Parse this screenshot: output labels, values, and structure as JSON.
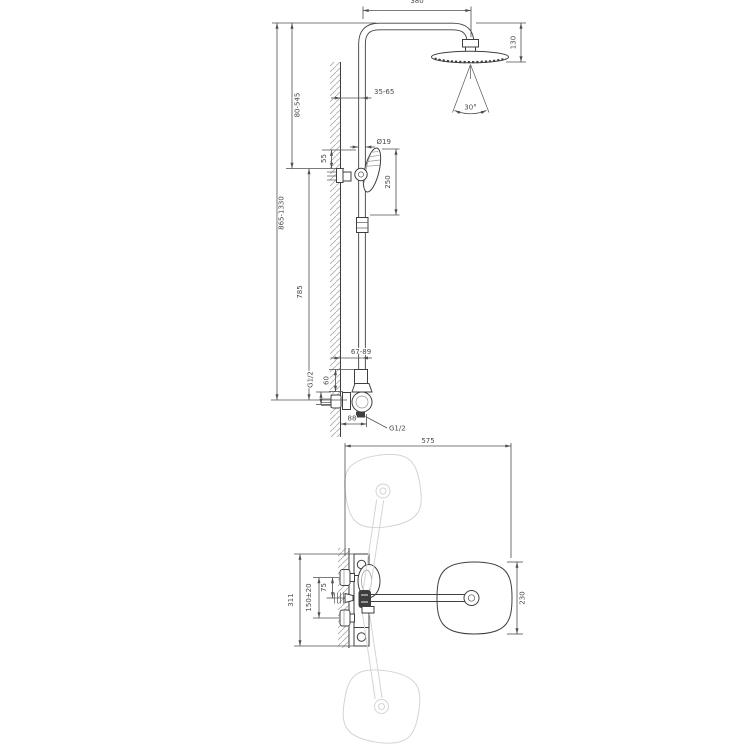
{
  "front": {
    "dims": {
      "arm_reach": "380",
      "head_drop": "130",
      "spray_angle": "30°",
      "wall_clearance_top": "35-65",
      "rail_diameter": "Ø19",
      "hand_shower_span": "250",
      "holder_offset": "55",
      "upper_adjust_range": "80-545",
      "overall_height_range": "865-1330",
      "rail_length": "785",
      "wall_clearance_bottom": "67-89",
      "valve_body_height": "60",
      "inlet_thread": "G1/2",
      "wall_to_outlet": "88",
      "outlet_thread": "G1/2"
    }
  },
  "plan": {
    "dims": {
      "overall_depth": "575",
      "bracket_height": "311",
      "inlet_spacing": "150±20",
      "inlet_to_center": "75",
      "head_width": "230"
    }
  },
  "colors": {
    "line": "#3f3f3f",
    "dim_text": "#4a4a4a",
    "ghost": "#d4d4d4",
    "hatch": "#ababab",
    "background": "#ffffff"
  }
}
